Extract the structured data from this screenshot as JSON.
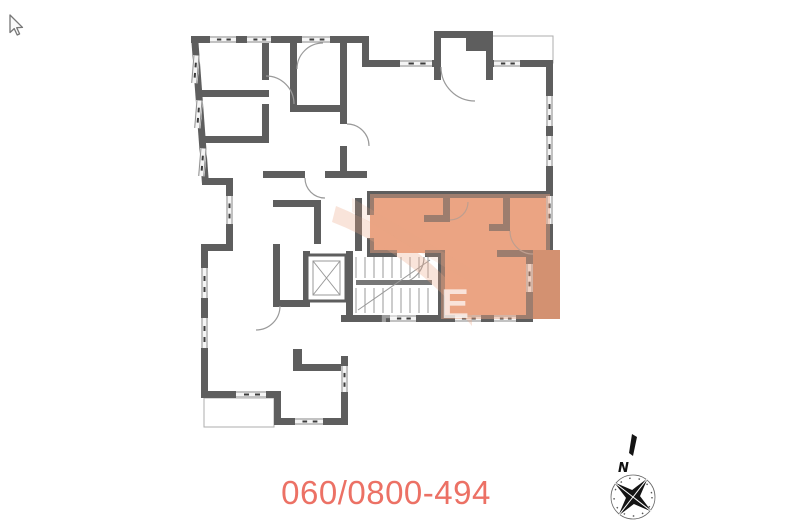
{
  "page": {
    "background_color": "#ffffff"
  },
  "floor_plan": {
    "wall_color": "#5e5e5e",
    "highlight_color": "#eba583",
    "loggia_color": "#bf8263",
    "watermark_letter": "E"
  },
  "contact": {
    "phone_number": "060/0800-494",
    "color": "#ec7165"
  },
  "compass": {
    "north_label": "N"
  }
}
